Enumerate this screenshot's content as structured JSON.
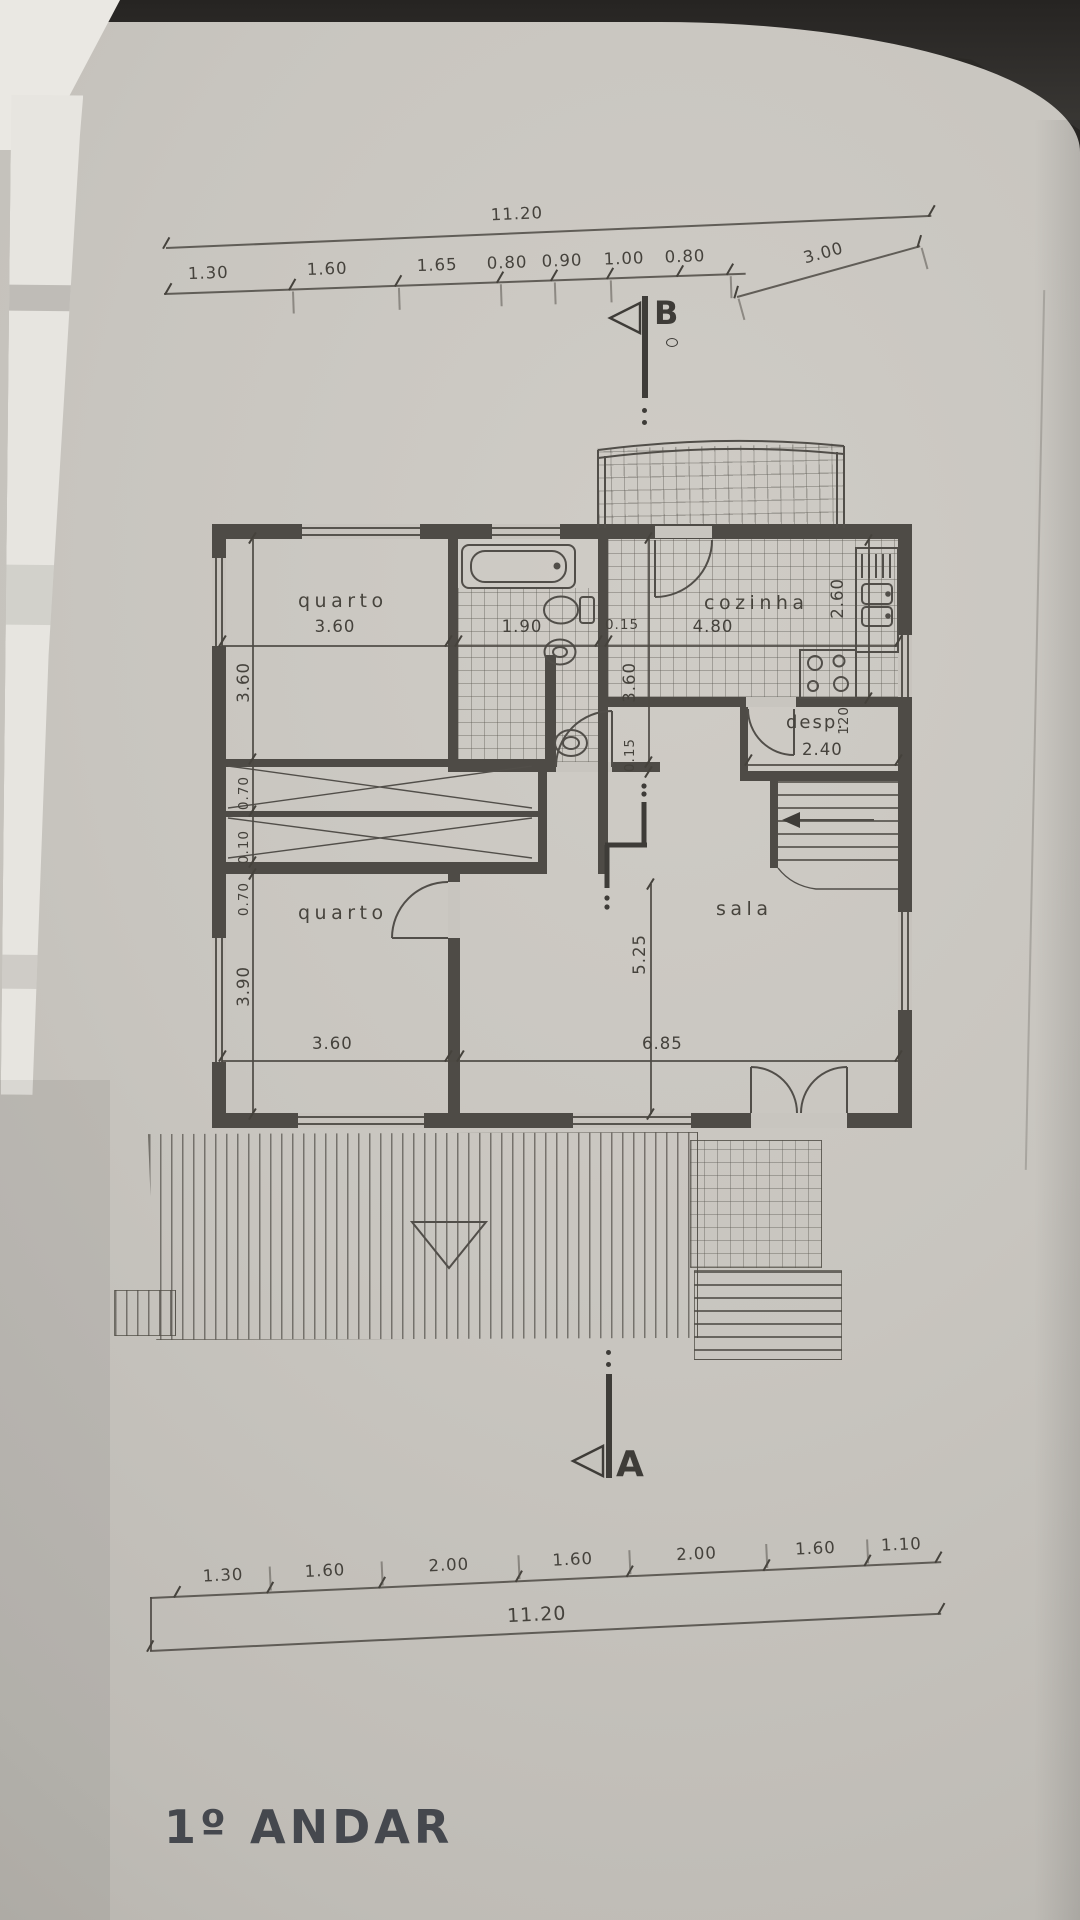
{
  "title": "1º ANDAR",
  "markers": {
    "top": "B",
    "bottom": "A"
  },
  "top_dims": {
    "total": "11.20",
    "segments": [
      "1.30",
      "1.60",
      "1.65",
      "0.80",
      "0.90",
      "1.00",
      "0.80"
    ],
    "offset": "3.00"
  },
  "bottom_dims": {
    "total": "11.20",
    "segments": [
      "1.30",
      "1.60",
      "2.00",
      "1.60",
      "2.00",
      "1.60",
      "1.10"
    ]
  },
  "rooms": {
    "quarto_top": "quarto",
    "cozinha": "cozinha",
    "despensa": "desp.",
    "quarto_bottom": "quarto",
    "sala": "sala"
  },
  "dims": {
    "quarto_top_w": "3.60",
    "bath_w": "1.90",
    "wall_a": "0.15",
    "cozinha_w": "4.80",
    "cozinha_d": "2.60",
    "desp_w": "2.40",
    "desp_d": "120",
    "bath_d": "3.60",
    "wall_b": "0.15",
    "left_top": "3.60",
    "closet_a": "0.70",
    "closet_gap": "0.10",
    "closet_b": "0.70",
    "left_bottom": "3.90",
    "sala_d": "5.25",
    "quarto_bottom_w": "3.60",
    "sala_w": "6.85"
  },
  "colors": {
    "paper": "#c8c5bf",
    "ink": "#4e4b46",
    "edge_dark": "#2f2d2a",
    "edge_white": "#eae8e3",
    "title_ink": "#45484e"
  }
}
